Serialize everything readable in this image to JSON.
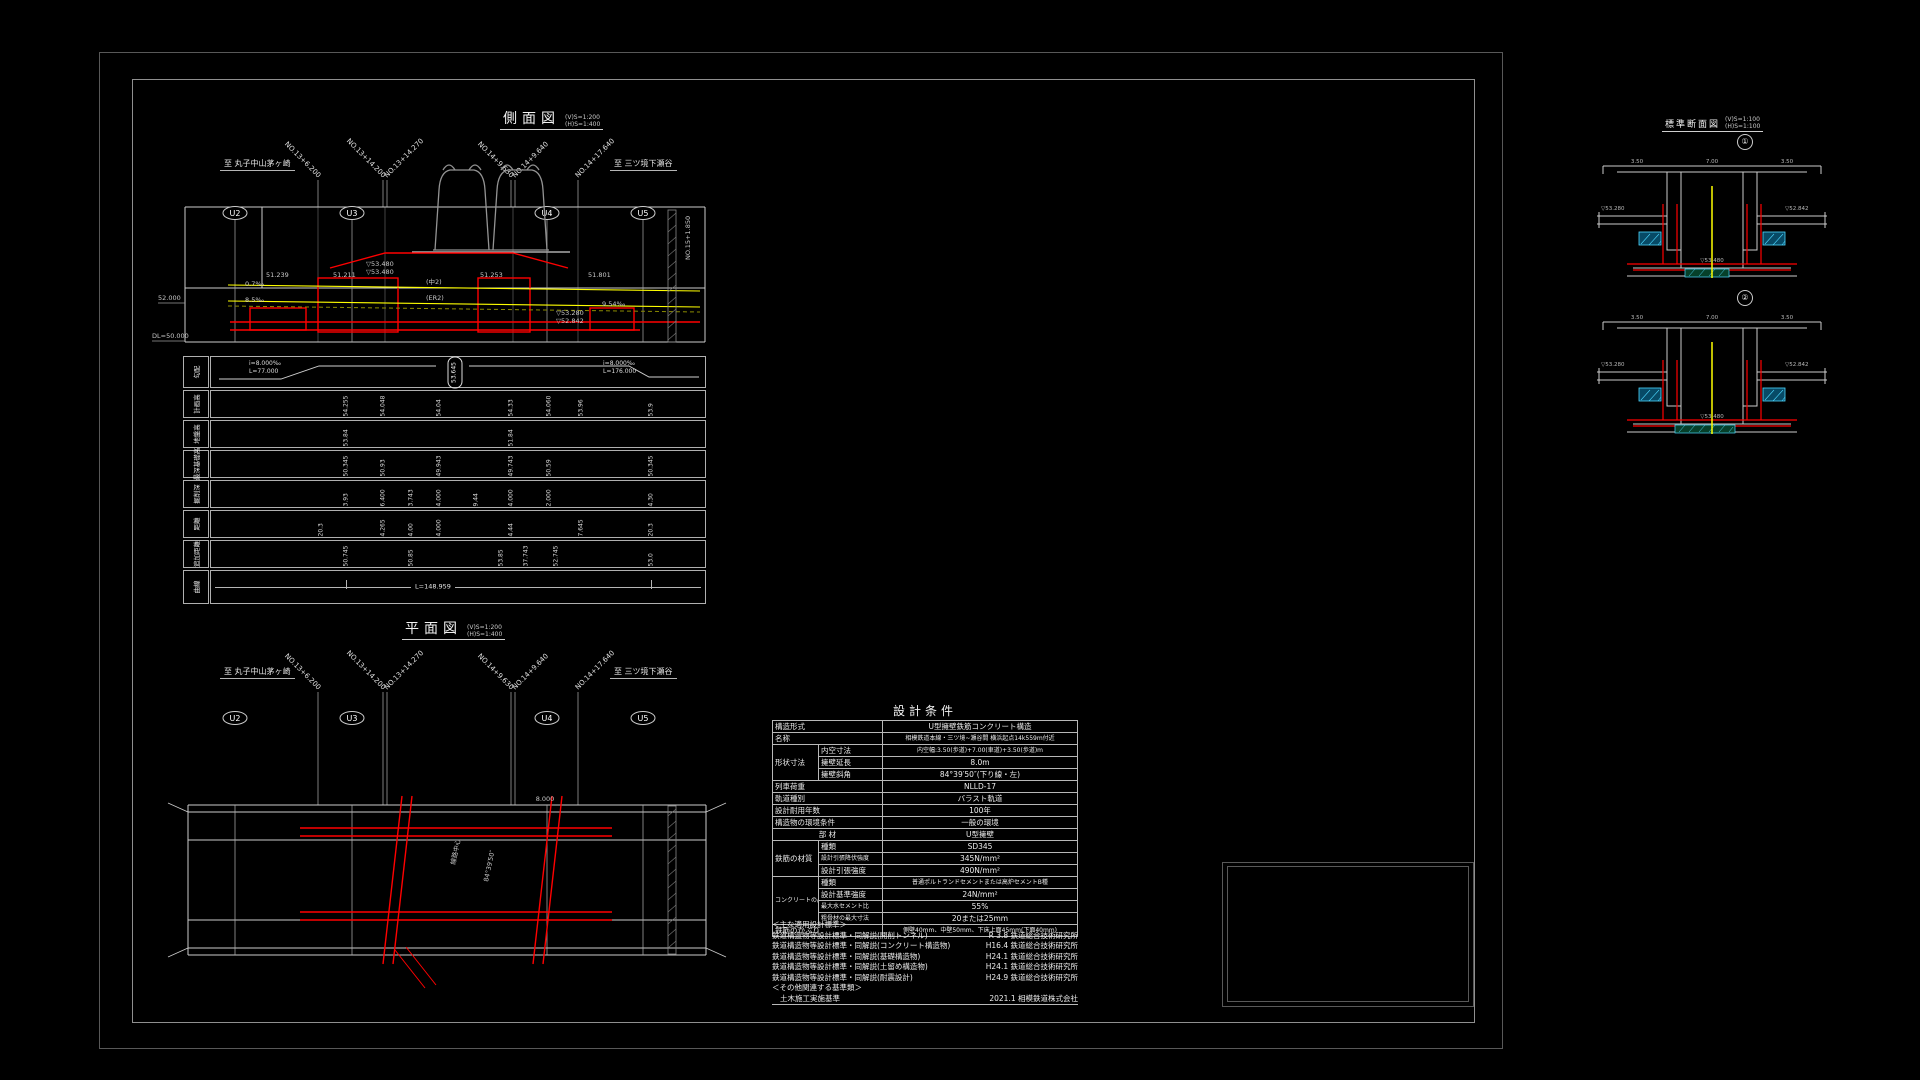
{
  "sheet": {
    "name": "railway-structure-drawing"
  },
  "side_view": {
    "title": "側面図",
    "scale_v": "(V)S=1:200",
    "scale_h": "(H)S=1:400",
    "to_left": "至 丸子中山茅ヶ崎",
    "to_right": "至 三ツ境下瀬谷",
    "stations": [
      "NO.13+6.200",
      "NO.13+14.200",
      "NO.13+14.270",
      "NO.14+9.630",
      "NO.14+9.640",
      "NO.14+17.640"
    ],
    "piers": [
      "U2",
      "U3",
      "U4",
      "U5"
    ],
    "elevations": [
      "52.000",
      "DL=50.000"
    ],
    "annotations": [
      "0.7‰",
      "8.5‰",
      "(中2)",
      "(ER2)",
      "51.239",
      "51.211",
      "51.253",
      "51.801",
      "▽53.480",
      "▽53.480",
      "▽53.280",
      "▽52.842",
      "9.54‰",
      "NO.15+1.850"
    ]
  },
  "bands": {
    "rows": [
      {
        "label": "勾配",
        "left1": "i=8.000‰",
        "left2": "L=77.000",
        "oval": "53.645",
        "right1": "i=8.000‰",
        "right2": "L=176.000"
      },
      {
        "label": "計画高",
        "values": [
          "54.255",
          "54.048",
          "54.04",
          "54.33",
          "54.060",
          "53.96",
          "53.9"
        ]
      },
      {
        "label": "地盤高",
        "values": [
          "53.84",
          "51.84"
        ]
      },
      {
        "label": "最深基礎高",
        "values": [
          "50.345",
          "50.93",
          "49.943",
          "49.743",
          "50.59",
          "50.345"
        ]
      },
      {
        "label": "掘削深",
        "values": [
          "3.93",
          "6.400",
          "3.743",
          "4.000",
          "9.44",
          "4.000",
          "2.000",
          "4.30"
        ]
      },
      {
        "label": "距離",
        "values": [
          "20.3",
          "4.265",
          "4.00",
          "4.000",
          "4.44",
          "7.645",
          "20.3"
        ]
      },
      {
        "label": "追加距離",
        "values": [
          "50.745",
          "50.85",
          "53.85",
          "37.743",
          "52.745",
          "53.0"
        ]
      },
      {
        "label": "曲線",
        "center": "L=148.959"
      }
    ]
  },
  "plan_view": {
    "title": "平面図",
    "scale_v": "(V)S=1:200",
    "scale_h": "(H)S=1:400",
    "to_left": "至 丸子中山茅ヶ崎",
    "to_right": "至 三ツ境下瀬谷",
    "stations": [
      "NO.13+6.200",
      "NO.13+14.200",
      "NO.13+14.270",
      "NO.14+9.630",
      "NO.14+9.640",
      "NO.14+17.640"
    ],
    "piers": [
      "U2",
      "U3",
      "U4",
      "U5"
    ],
    "notes": [
      "線路中心",
      "84°39′50″",
      "8.000"
    ]
  },
  "design_table": {
    "title": "設計条件",
    "rows": {
      "r1": {
        "label": "構造形式",
        "value": "U型擁壁鉄筋コンクリート構造"
      },
      "r2": {
        "label": "名称",
        "value": "相模鉄道本線・三ツ境~瀬谷間 横浜起点14k559m付近"
      },
      "r3": {
        "group": "形状寸法",
        "sub": "内空寸法",
        "value": "内空幅:3.50(歩道)+7.00(車道)+3.50(歩道)m"
      },
      "r4": {
        "sub": "擁壁延長",
        "value": "8.0m"
      },
      "r5": {
        "sub": "擁壁斜角",
        "value": "84°39′50″(下り線・左)"
      },
      "r6": {
        "label": "列車荷重",
        "value": "NLLD-17"
      },
      "r7": {
        "label": "軌道種別",
        "value": "バラスト軌道"
      },
      "r8": {
        "label": "設計耐用年数",
        "value": "100年"
      },
      "r9": {
        "label": "構造物の環境条件",
        "value": "一般の環境"
      },
      "r10": {
        "label": "部  材",
        "value": "U型擁壁"
      },
      "r11": {
        "group": "鉄筋の材質",
        "sub": "種類",
        "value": "SD345"
      },
      "r12": {
        "sub": "設計引張降伏強度",
        "value": "345N/mm²"
      },
      "r13": {
        "sub": "設計引張強度",
        "value": "490N/mm²"
      },
      "r14": {
        "group": "コンクリートの品質",
        "sub": "種類",
        "value": "普通ポルトランドセメントまたは高炉セメントB種"
      },
      "r15": {
        "sub": "設計基準強度",
        "value": "24N/mm²"
      },
      "r16": {
        "sub": "最大水セメント比",
        "value": "55%"
      },
      "r17": {
        "sub": "粗骨材の最大寸法",
        "value": "20または25mm"
      },
      "r18": {
        "label": "鉄筋のかぶり",
        "value": "側壁40mm、中壁50mm、下床上面45mm(下面40mm)"
      }
    },
    "standards_header": "＜主な適用設計標準＞",
    "standards": [
      {
        "name": "鉄道構造物等設計標準・同解説(開削トンネル)",
        "ref": "R 3.8 鉄道総合技術研究所"
      },
      {
        "name": "鉄道構造物等設計標準・同解説(コンクリート構造物)",
        "ref": "H16.4 鉄道総合技術研究所"
      },
      {
        "name": "鉄道構造物等設計標準・同解説(基礎構造物)",
        "ref": "H24.1 鉄道総合技術研究所"
      },
      {
        "name": "鉄道構造物等設計標準・同解説(土留め構造物)",
        "ref": "H24.1 鉄道総合技術研究所"
      },
      {
        "name": "鉄道構造物等設計標準・同解説(耐震設計)",
        "ref": "H24.9 鉄道総合技術研究所"
      }
    ],
    "others_header": "＜その他関連する基準類＞",
    "others": [
      {
        "name": "土木施工実施基準",
        "ref": "2021.1 相模鉄道株式会社"
      }
    ]
  },
  "sections": {
    "title": "標準断面図",
    "scale_v": "(V)S=1:100",
    "scale_h": "(H)S=1:100",
    "labels": [
      "①",
      "②"
    ],
    "dims": [
      "3.50",
      "7.00",
      "3.50"
    ],
    "marks": [
      "▽53.280",
      "▽52.842",
      "▽53.480"
    ]
  },
  "colors": {
    "highlight_red": "#ff0000",
    "rail_yellow": "#ffff00",
    "water_cyan": "#4dd8ff",
    "ground_olive": "#8a8a00",
    "line_white": "#cccccc"
  }
}
